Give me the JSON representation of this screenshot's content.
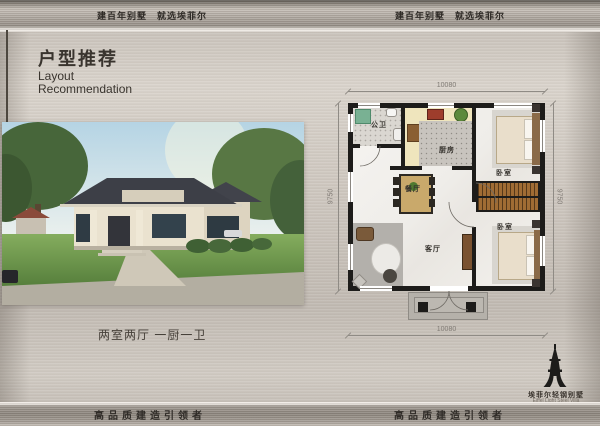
{
  "header": {
    "slogans": [
      "建百年别墅　就选埃菲尔",
      "建百年别墅　就选埃菲尔"
    ]
  },
  "intro": {
    "title_cn": "户型推荐",
    "title_en_line1": "Layout",
    "title_en_line2": "Recommendation",
    "caption": "两室两厅 一厨一卫"
  },
  "floorplan": {
    "dimensions": {
      "top": "10080",
      "bottom": "10080",
      "left": "9750",
      "right": "9750"
    },
    "rooms": {
      "bathroom": "公卫",
      "kitchen": "厨房",
      "dining": "餐厅",
      "living": "客厅",
      "bedroom_top": "卧室",
      "bedroom_bottom": "卧室"
    }
  },
  "footer": {
    "slogans": [
      "高品质建造引领者",
      "高品质建造引领者"
    ]
  },
  "logo": {
    "name_cn": "埃菲尔轻钢别墅",
    "name_en": "Eiffel Light Steel Villa"
  },
  "colors": {
    "metal_light": "#d8d2ca",
    "metal_dark": "#8d867e",
    "wall_black": "#1d1c1a",
    "counter_cream": "#efe5bd",
    "wood_brown": "#a06c34",
    "shower_green": "#79b193",
    "lawn_green": "#6d9c4e",
    "label_text": "#35322d",
    "dim_text": "#807b75"
  }
}
